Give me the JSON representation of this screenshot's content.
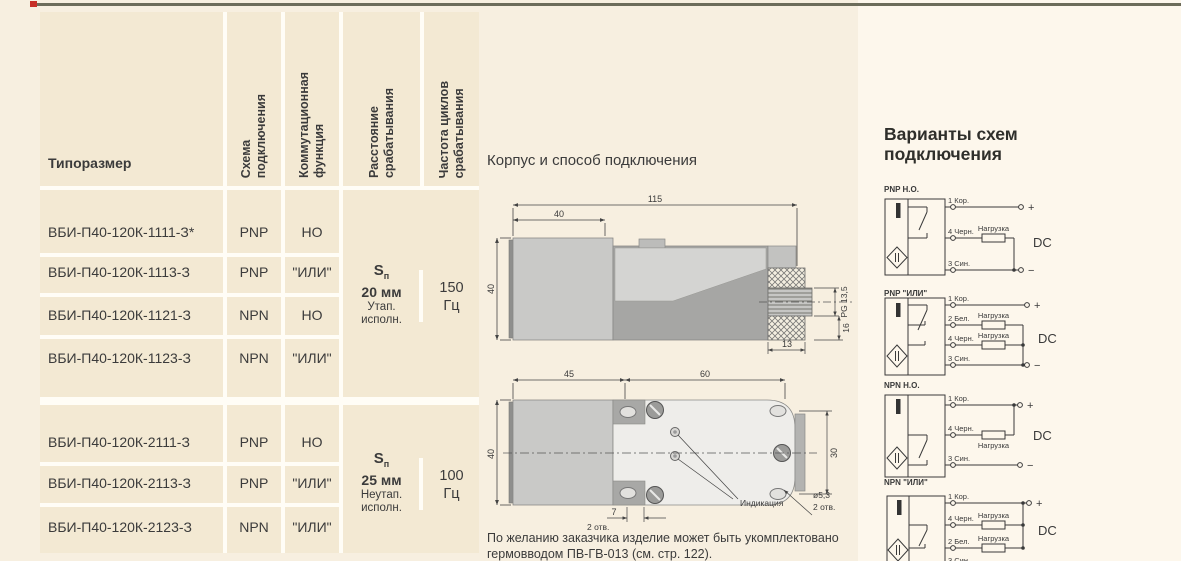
{
  "table": {
    "headers": {
      "size": "Типоразмер",
      "scheme": "Схема\nподключения",
      "function": "Коммутационная\nфункция",
      "distance": "Расстояние\nсрабатывания",
      "frequency": "Частота циклов\nсрабатывания"
    },
    "groups": [
      {
        "rows": [
          {
            "model": "ВБИ-П40-120К-1111-З*",
            "scheme": "PNP",
            "function": "НО"
          },
          {
            "model": "ВБИ-П40-120К-1113-З",
            "scheme": "PNP",
            "function": "\"ИЛИ\""
          },
          {
            "model": "ВБИ-П40-120К-1121-З",
            "scheme": "NPN",
            "function": "НО"
          },
          {
            "model": "ВБИ-П40-120К-1123-З",
            "scheme": "NPN",
            "function": "\"ИЛИ\""
          }
        ],
        "distance": {
          "symbol": "S",
          "symbol_sub": "п",
          "value": "20 мм",
          "note": "Утап.\nисполн."
        },
        "frequency": "150\nГц"
      },
      {
        "rows": [
          {
            "model": "ВБИ-П40-120К-2111-З",
            "scheme": "PNP",
            "function": "НО"
          },
          {
            "model": "ВБИ-П40-120К-2113-З",
            "scheme": "PNP",
            "function": "\"ИЛИ\""
          },
          {
            "model": "ВБИ-П40-120К-2123-З",
            "scheme": "NPN",
            "function": "\"ИЛИ\""
          }
        ],
        "distance": {
          "symbol": "S",
          "symbol_sub": "п",
          "value": "25 мм",
          "note": "Неутап.\nисполн."
        },
        "frequency": "100\nГц"
      }
    ]
  },
  "drawings": {
    "title": "Корпус и способ подключения",
    "side": {
      "total": "115",
      "front": "40",
      "height": "40",
      "thread": "PG 13,5",
      "d13": "13",
      "d16": "16"
    },
    "top": {
      "front": "45",
      "back": "60",
      "height": "40",
      "spacing": "30",
      "hole": "ø5,3",
      "holes_note": "2 отв.",
      "pitch": "7",
      "indication": "Индикация"
    },
    "note": "По желанию заказчика изделие может быть укомплектовано гермовводом ПВ-ГВ-013 (см. стр. 122)."
  },
  "schemes": {
    "title": "Варианты схем\nподключения",
    "dc": "DC",
    "plus": "+",
    "minus": "−",
    "load": "Нагрузка",
    "diagrams": [
      {
        "title": "PNP Н.О.",
        "wires": [
          "1 Кор.",
          "4 Черн.",
          "3 Син."
        ]
      },
      {
        "title": "PNP \"ИЛИ\"",
        "wires": [
          "1 Кор.",
          "2 Бел.",
          "4 Черн.",
          "3 Син."
        ]
      },
      {
        "title": "NPN Н.О.",
        "wires": [
          "1 Кор.",
          "4 Черн.",
          "3 Син."
        ]
      },
      {
        "title": "NPN \"ИЛИ\"",
        "wires": [
          "1 Кор.",
          "4 Черн.",
          "2 Бел.",
          "3 Син."
        ]
      }
    ]
  }
}
